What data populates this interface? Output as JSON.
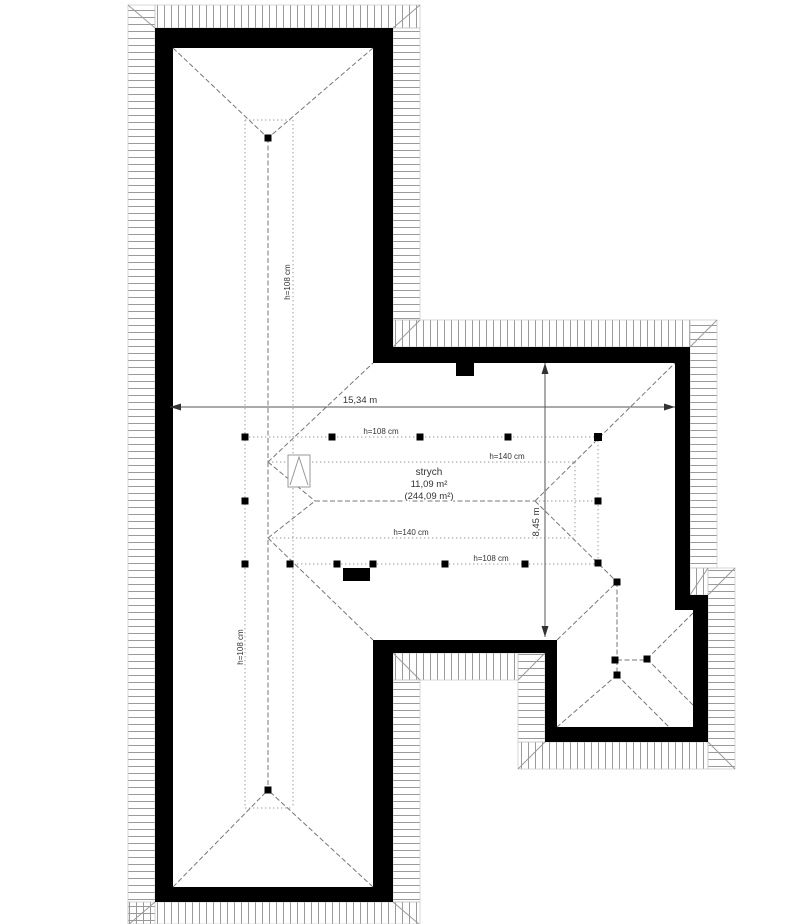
{
  "room": {
    "name": "strych",
    "area": "11,09 m²",
    "area_total": "(244,09 m²)"
  },
  "dimensions": {
    "width": "15,34 m",
    "depth": "8,45 m"
  },
  "height_labels": {
    "h108": "h=108 cm",
    "h140": "h=140 cm"
  },
  "colors": {
    "wall": "#000000",
    "hatch_line": "#9a9a9a",
    "ridge_line": "#777777",
    "contour_line": "#9a9a9a",
    "dimension_line": "#555555",
    "text": "#333333",
    "background": "#ffffff"
  }
}
